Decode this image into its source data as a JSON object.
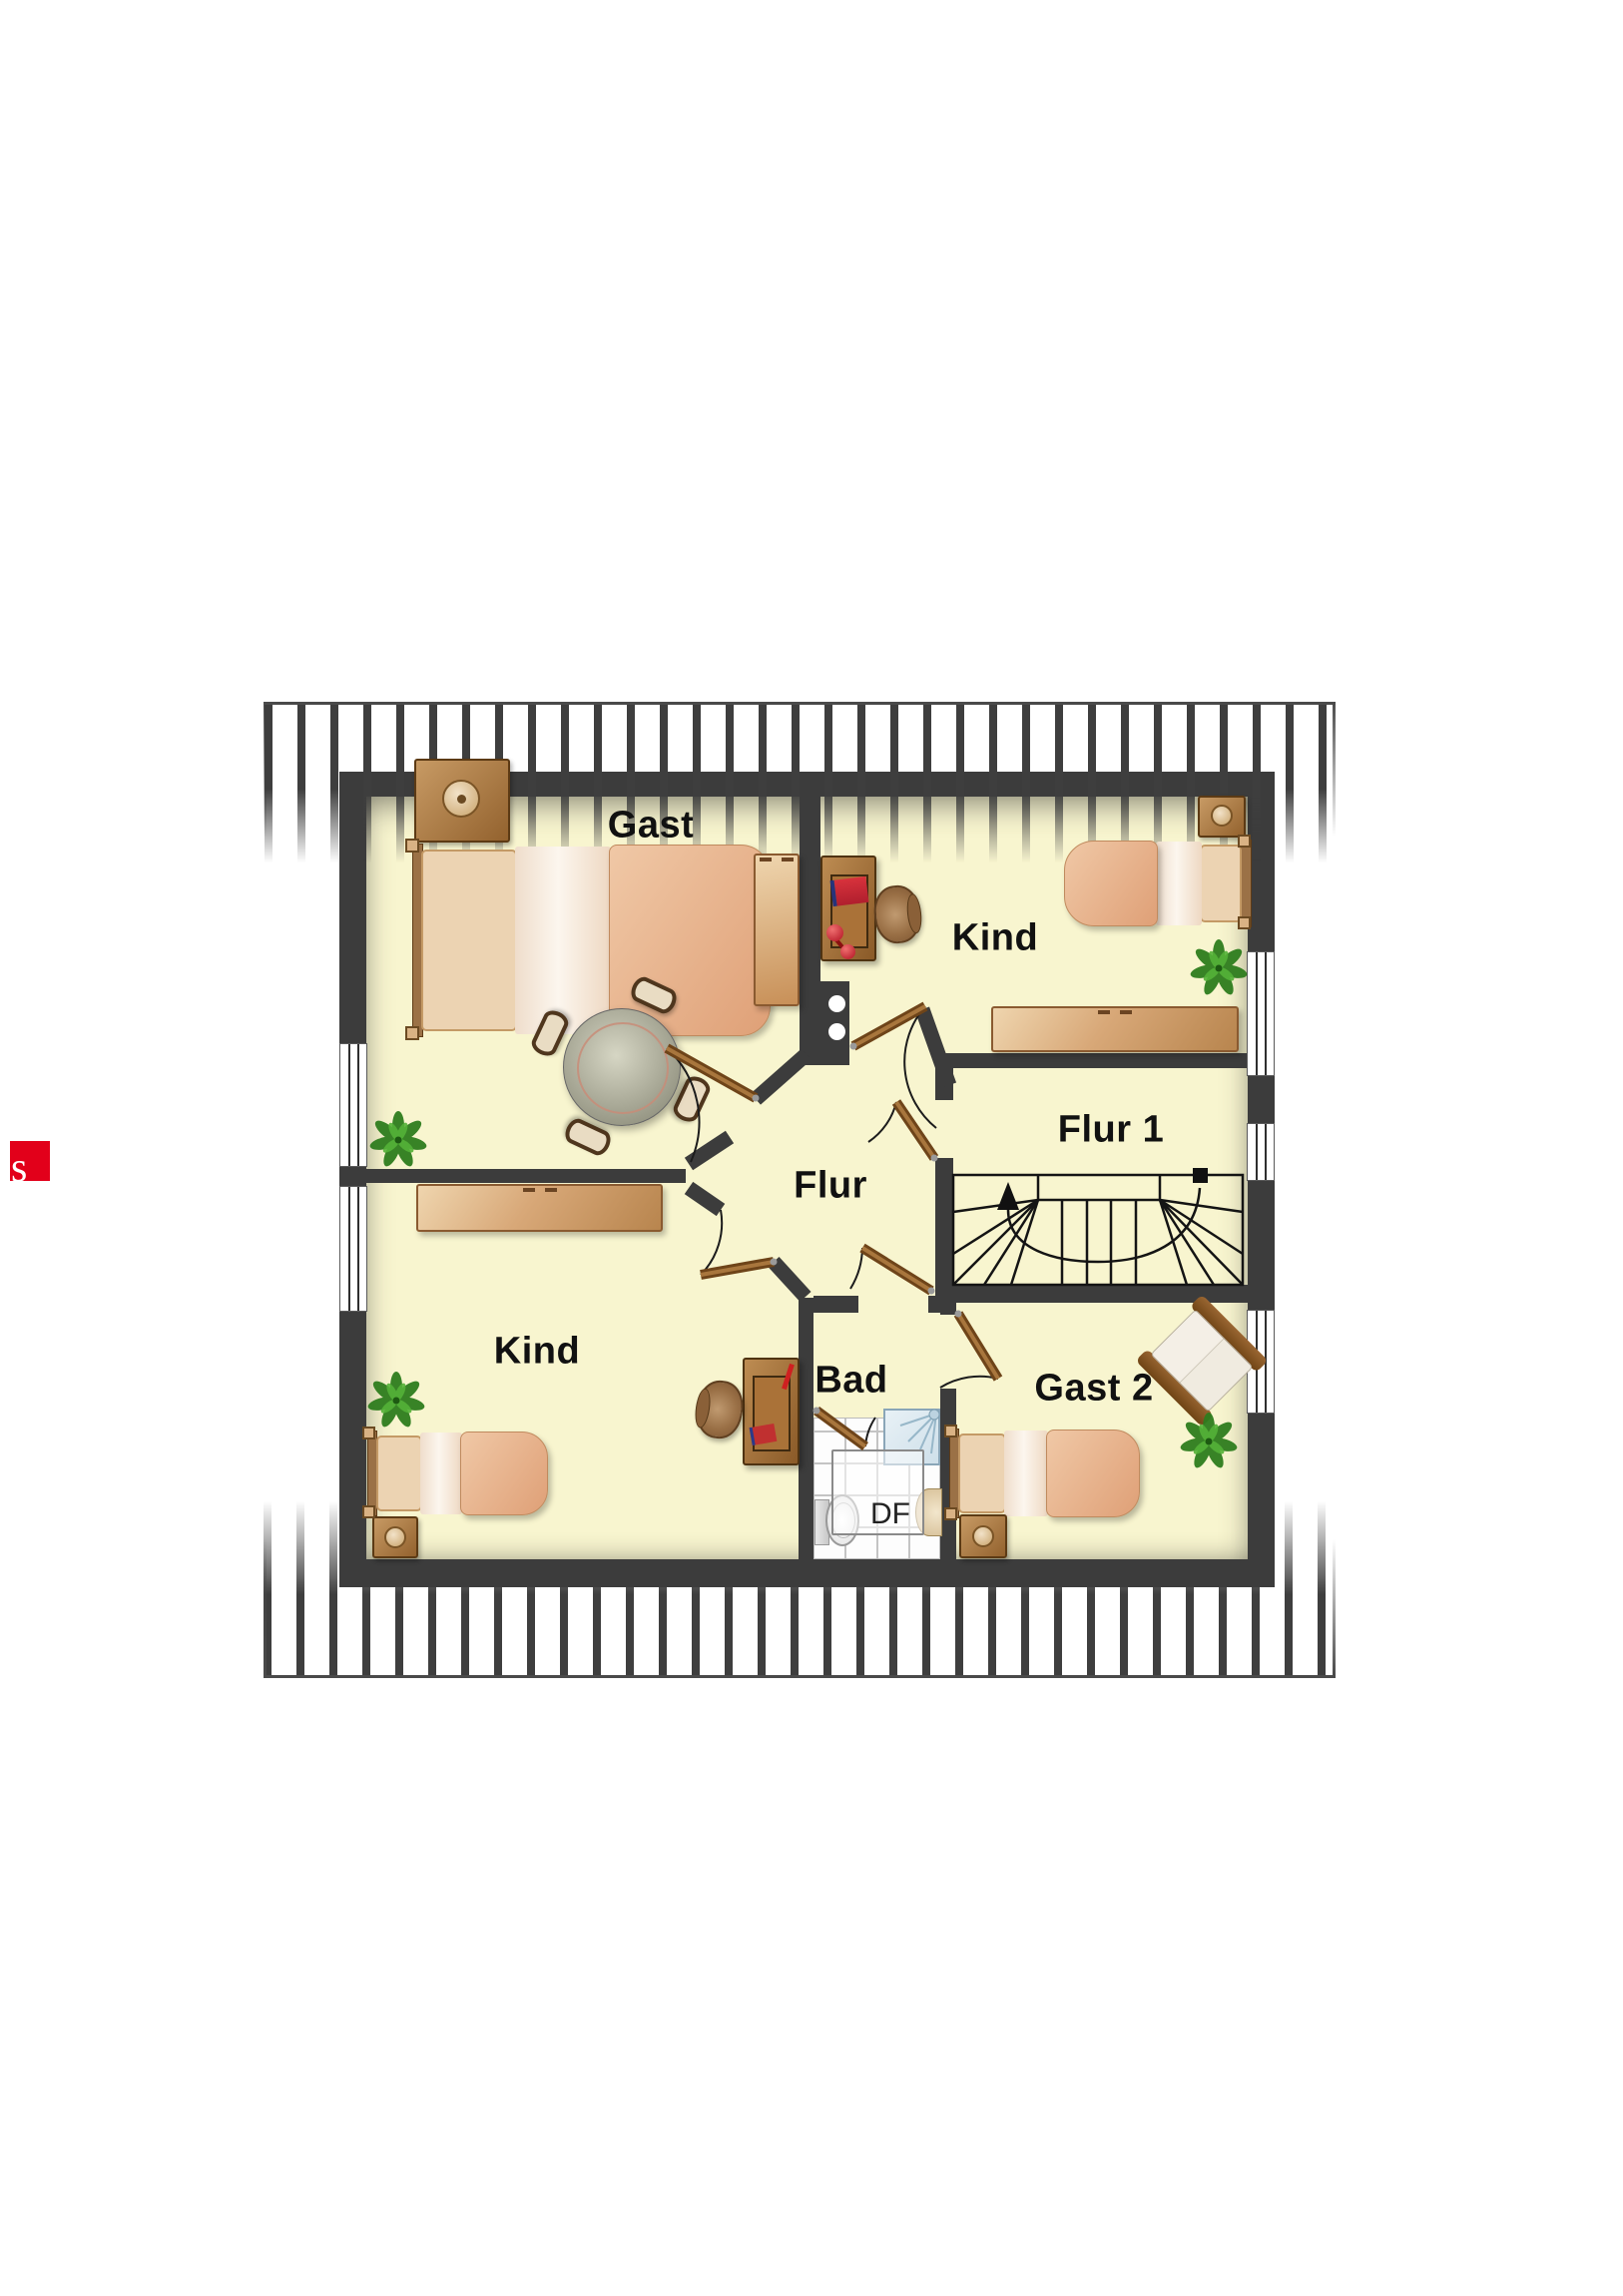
{
  "logo": {
    "letter": "s",
    "color": "#e2001a"
  },
  "plan": {
    "rooms": [
      {
        "id": "gast",
        "label": "Gast"
      },
      {
        "id": "kind-top",
        "label": "Kind"
      },
      {
        "id": "flur-1",
        "label": "Flur 1"
      },
      {
        "id": "flur",
        "label": "Flur"
      },
      {
        "id": "kind-bottom",
        "label": "Kind"
      },
      {
        "id": "bad",
        "label": "Bad"
      },
      {
        "id": "gast-2",
        "label": "Gast 2"
      }
    ],
    "skylight": {
      "label": "DF"
    },
    "colors": {
      "floor": "#f8f5cf",
      "wall": "#3c3c3c",
      "roof_hatch": "#3e3e3e",
      "door_wood": "#6e4419",
      "label_text": "#111111",
      "accent_red": "#c93038",
      "plant_green": "#2e7d1e"
    }
  }
}
